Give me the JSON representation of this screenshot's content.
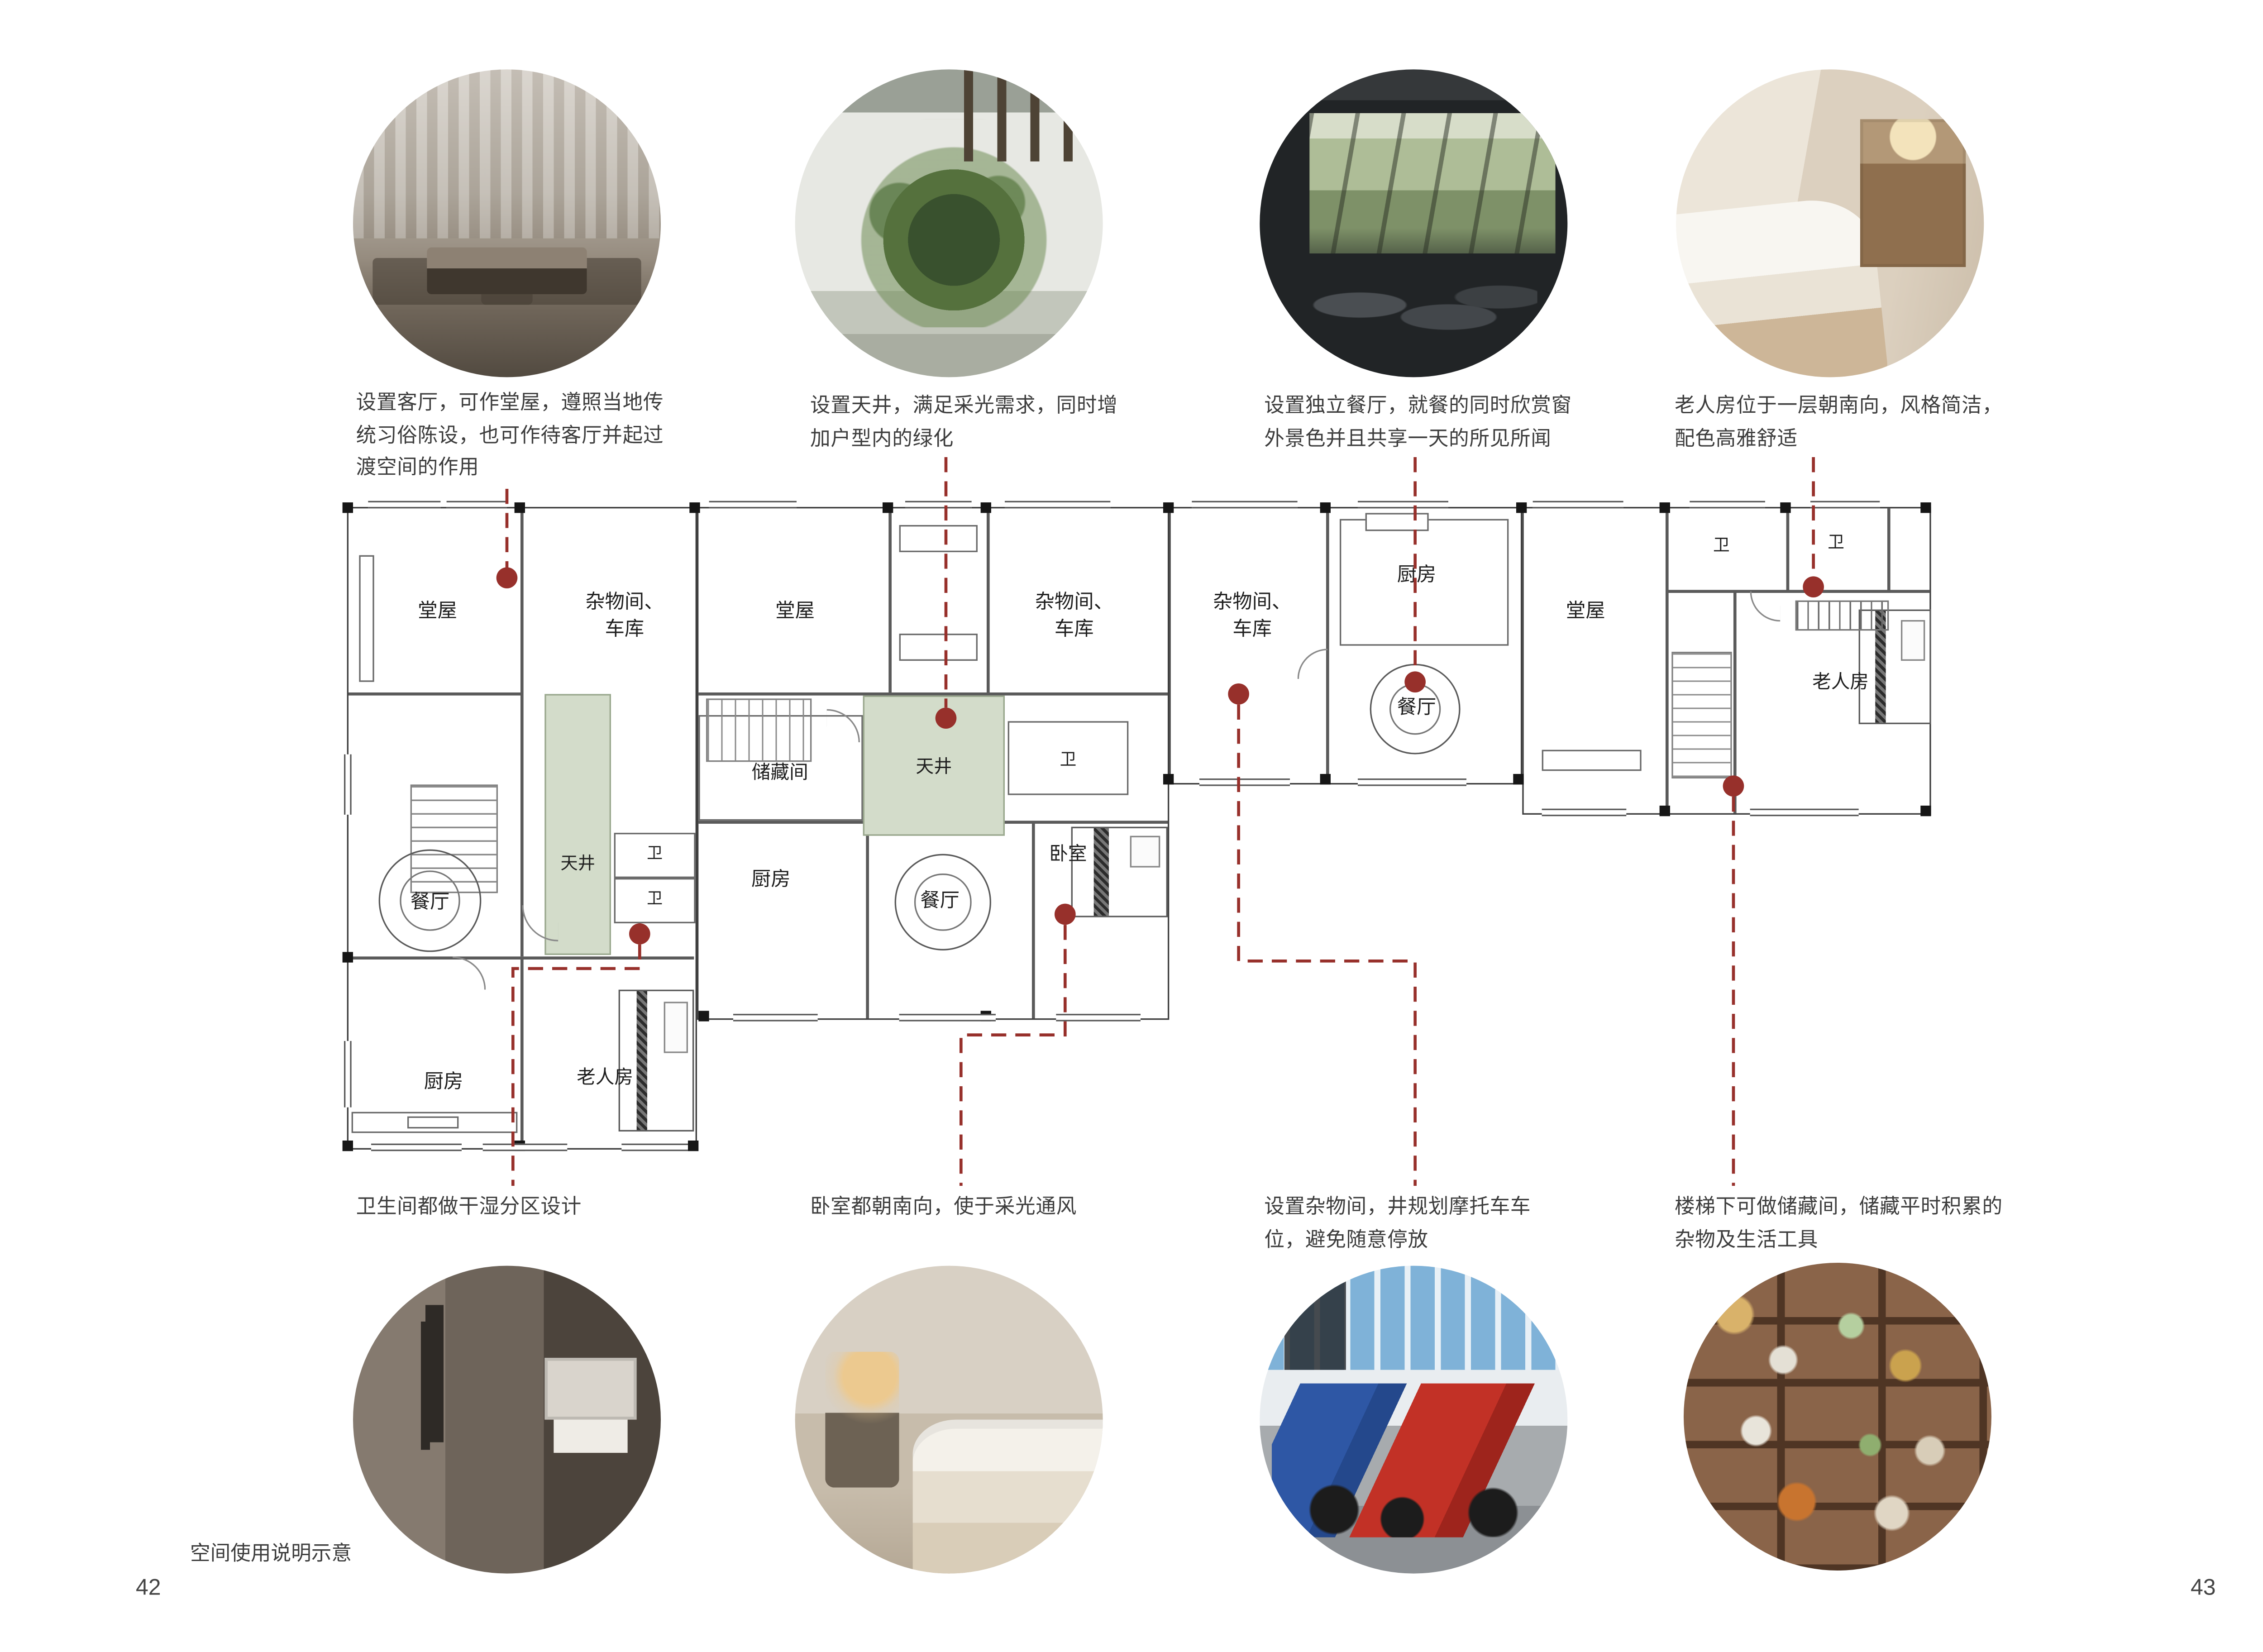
{
  "page": {
    "footer_note": "空间使用说明示意",
    "page_number_left": "42",
    "page_number_right": "43"
  },
  "colors": {
    "leader_red": "#97302b",
    "courtyard_fill": "#d3dcca"
  },
  "top_annotations": [
    {
      "photo": "living-room-photo",
      "text": "设置客厅，可作堂屋，遵照当地传统习俗陈设，也可作待客厅并起过渡空间的作用"
    },
    {
      "photo": "courtyard-photo",
      "text": "设置天井，满足采光需求，同时增加户型内的绿化"
    },
    {
      "photo": "dining-room-photo",
      "text": "设置独立餐厅，就餐的同时欣赏窗外景色并且共享一天的所见所闻"
    },
    {
      "photo": "elder-bedroom-photo",
      "text": "老人房位于一层朝南向，风格简洁，配色高雅舒适"
    }
  ],
  "bottom_annotations": [
    {
      "photo": "bathroom-photo",
      "text": "卫生间都做干湿分区设计"
    },
    {
      "photo": "bedroom-photo",
      "text": "卧室都朝南向，使于采光通风"
    },
    {
      "photo": "motorcycle-parking-photo",
      "text": "设置杂物间，井规划摩托车车位，避免随意停放"
    },
    {
      "photo": "pantry-shelves-photo",
      "text": "楼梯下可做储藏间，储藏平时积累的杂物及生活工具"
    }
  ],
  "floor_plan": {
    "units": [
      {
        "rooms": {
          "hall": "堂屋",
          "storage_garage": "杂物间、车库",
          "courtyard": "天井",
          "bath_a": "卫",
          "bath_b": "卫",
          "dining": "餐厅",
          "kitchen": "厨房",
          "elder_room": "老人房"
        }
      },
      {
        "rooms": {
          "hall": "堂屋",
          "storage_garage": "杂物间、车库",
          "pantry": "储藏间",
          "courtyard": "天井",
          "bath": "卫",
          "kitchen": "厨房",
          "dining": "餐厅",
          "bedroom": "卧室"
        }
      },
      {
        "rooms": {
          "storage_garage": "杂物间、车库",
          "kitchen": "厨房",
          "dining": "餐厅"
        }
      },
      {
        "rooms": {
          "hall": "堂屋",
          "bath_a": "卫",
          "bath_b": "卫",
          "elder_room": "老人房"
        }
      }
    ]
  }
}
